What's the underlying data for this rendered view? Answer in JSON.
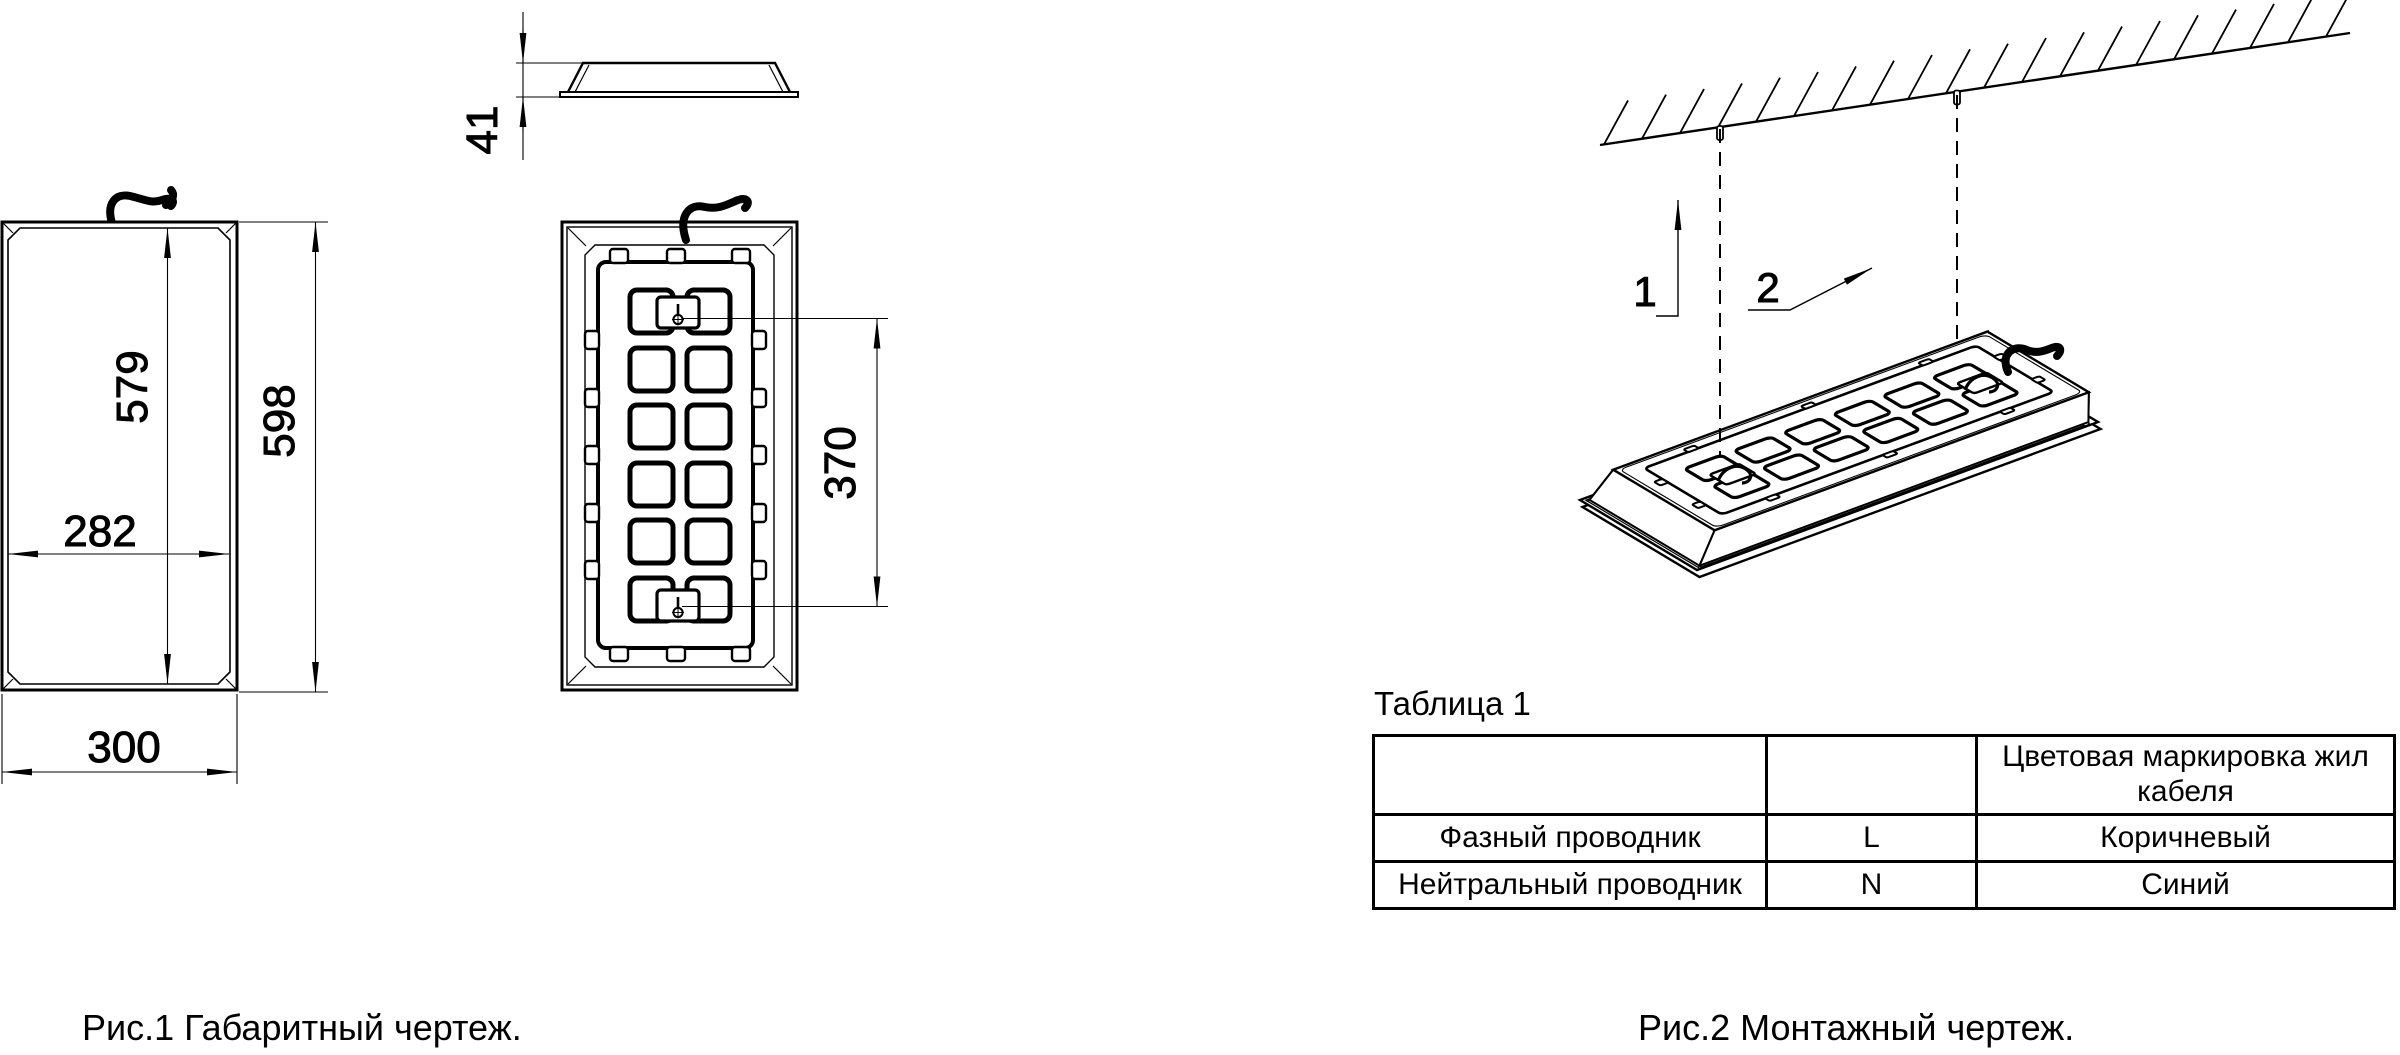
{
  "page": {
    "paper_color": "#ffffff",
    "ink_color": "#000000"
  },
  "figure1": {
    "caption": "Рис.1 Габаритный чертеж.",
    "dimensions": {
      "profile_height": "41",
      "front_inner_height": "579",
      "front_outer_height": "598",
      "front_inner_width": "282",
      "front_outer_width": "300",
      "mount_hole_spacing": "370"
    }
  },
  "figure2": {
    "caption": "Рис.2 Монтажный чертеж.",
    "callouts": [
      {
        "label": "1"
      },
      {
        "label": "2"
      }
    ]
  },
  "table1": {
    "title": "Таблица 1",
    "columns": [
      "",
      "",
      "Цветовая маркировка жил кабеля"
    ],
    "rows": [
      [
        "Фазный проводник",
        "L",
        "Коричневый"
      ],
      [
        "Нейтральный проводник",
        "N",
        "Синий"
      ]
    ]
  }
}
